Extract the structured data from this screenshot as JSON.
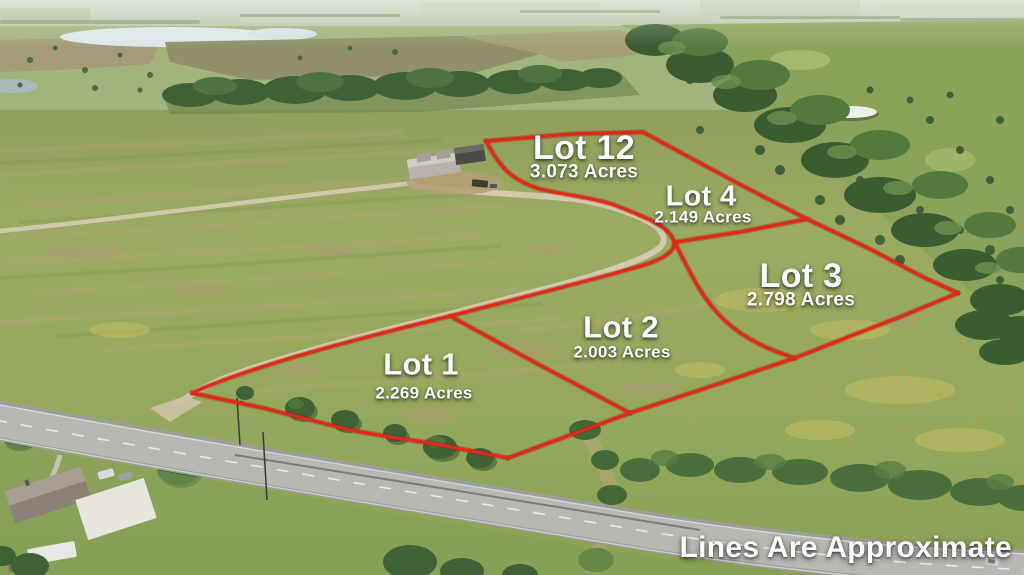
{
  "photo": {
    "description": "Aerial drone photo of pasture land subdivided into lots outlined in red",
    "disclaimer": "Lines Are Approximate"
  },
  "lots": [
    {
      "id": "lot-12",
      "name": "Lot 12",
      "acres": "3.073 Acres"
    },
    {
      "id": "lot-4",
      "name": "Lot 4",
      "acres": "2.149 Acres"
    },
    {
      "id": "lot-3",
      "name": "Lot 3",
      "acres": "2.798 Acres"
    },
    {
      "id": "lot-2",
      "name": "Lot 2",
      "acres": "2.003 Acres"
    },
    {
      "id": "lot-1",
      "name": "Lot 1",
      "acres": "2.269 Acres"
    }
  ],
  "colors": {
    "boundary_line": "#e42818",
    "label_text": "#ffffff"
  }
}
